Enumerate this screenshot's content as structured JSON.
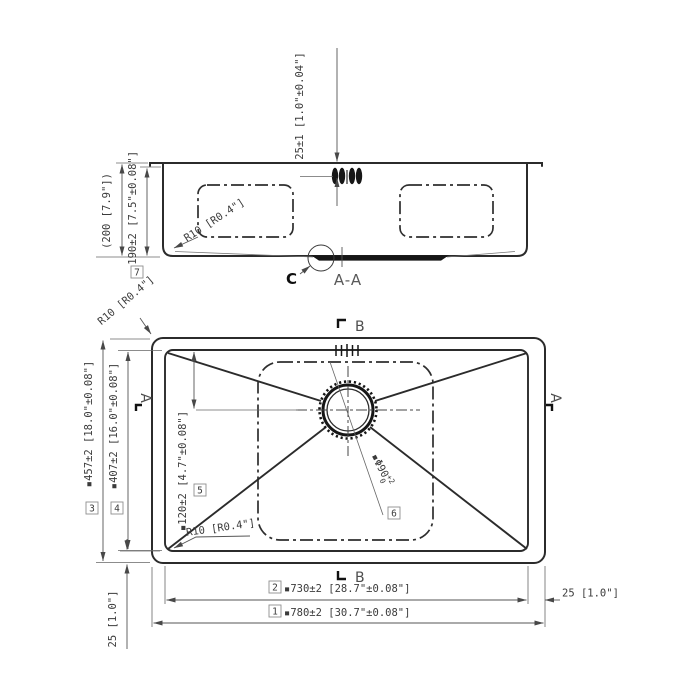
{
  "colors": {
    "background": "#ffffff",
    "outline": "#2b2b2b",
    "dimension": "#555555",
    "text": "#3b3b3b"
  },
  "section_view": {
    "label": "A-A",
    "detail_label": "C",
    "dim_faucet_offset": "25±1 [1.0\"±0.04\"]",
    "dim_overall_depth": "(200 [7.9\"])",
    "dim_bowl_depth": {
      "ref": "7",
      "value": "▪190±2 [7.5\"±0.08\"]"
    },
    "dim_corner_radius": "R10 [R0.4\"]"
  },
  "plan_view": {
    "section_marker_b": "B",
    "section_marker_a": "A",
    "dim_corner_radius_top": "R10 [R0.4\"]",
    "dim_corner_radius_bottom": "R10 [R0.4\"]",
    "dim_overall_length": {
      "ref": "1",
      "value": "▪780±2 [30.7\"±0.08\"]"
    },
    "dim_bowl_length": {
      "ref": "2",
      "value": "▪730±2 [28.7\"±0.08\"]"
    },
    "dim_overall_width": {
      "ref": "3",
      "value": "▪457±2 [18.0\"±0.08\"]"
    },
    "dim_bowl_width": {
      "ref": "4",
      "value": "▪407±2 [16.0\"±0.08\"]"
    },
    "dim_drain_offset": {
      "ref": "5",
      "value": "▪120±2 [4.7\"±0.08\"]"
    },
    "dim_drain_diameter": {
      "ref": "6",
      "value": "▪Φ90",
      "tol_upper": "+2",
      "tol_lower": "0"
    },
    "dim_rim_right": "25 [1.0\"]",
    "dim_rim_left": "25 [1.0\"]"
  }
}
